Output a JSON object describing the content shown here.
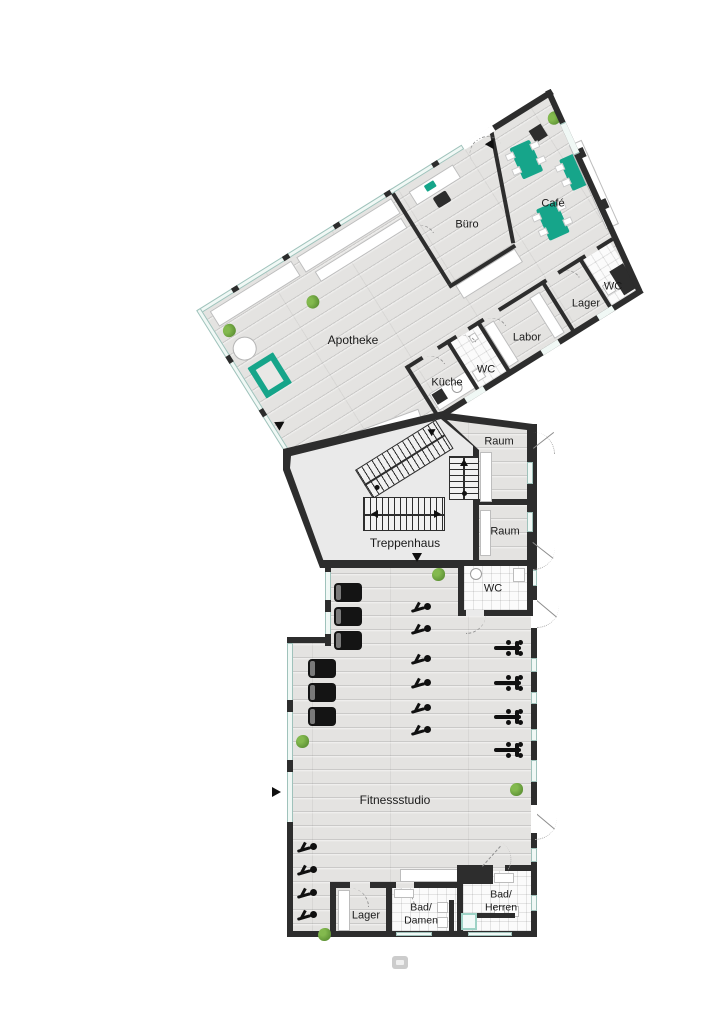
{
  "plan": {
    "type": "floor-plan",
    "rooms": {
      "apotheke": {
        "label": "Apotheke"
      },
      "buero": {
        "label": "Büro"
      },
      "cafe": {
        "label": "Café"
      },
      "wc_wing": {
        "label": "WC"
      },
      "lager_wing": {
        "label": "Lager"
      },
      "labor": {
        "label": "Labor"
      },
      "kueche": {
        "label": "Küche"
      },
      "wc_kueche": {
        "label": "WC"
      },
      "raum_upper": {
        "label": "Raum"
      },
      "raum_lower": {
        "label": "Raum"
      },
      "treppenhaus": {
        "label": "Treppenhaus"
      },
      "wc_fitness": {
        "label": "WC"
      },
      "fitnessstudio": {
        "label": "Fitnessstudio"
      },
      "lager_fitness": {
        "label": "Lager"
      },
      "bad_damen": {
        "label": "Bad/\nDamen"
      },
      "bad_herren": {
        "label": "Bad/\nHerren"
      }
    },
    "colors": {
      "wall": "#2d2d2d",
      "furniture_accent": "#16a58a",
      "floor_wood": "#e4e3e1",
      "floor_stair_hall": "#eaeaea",
      "glass": "#f0f8f5",
      "plant": "#6fa53f"
    },
    "icons": {
      "entrance_arrow": "filled-triangle",
      "stair_direction_arrow": "filled-triangle",
      "plant": "green-bush",
      "treadmill": "black-rounded-rect",
      "exercise_bike": "black-glyph",
      "weight_bench": "black-bar-with-plates"
    }
  }
}
